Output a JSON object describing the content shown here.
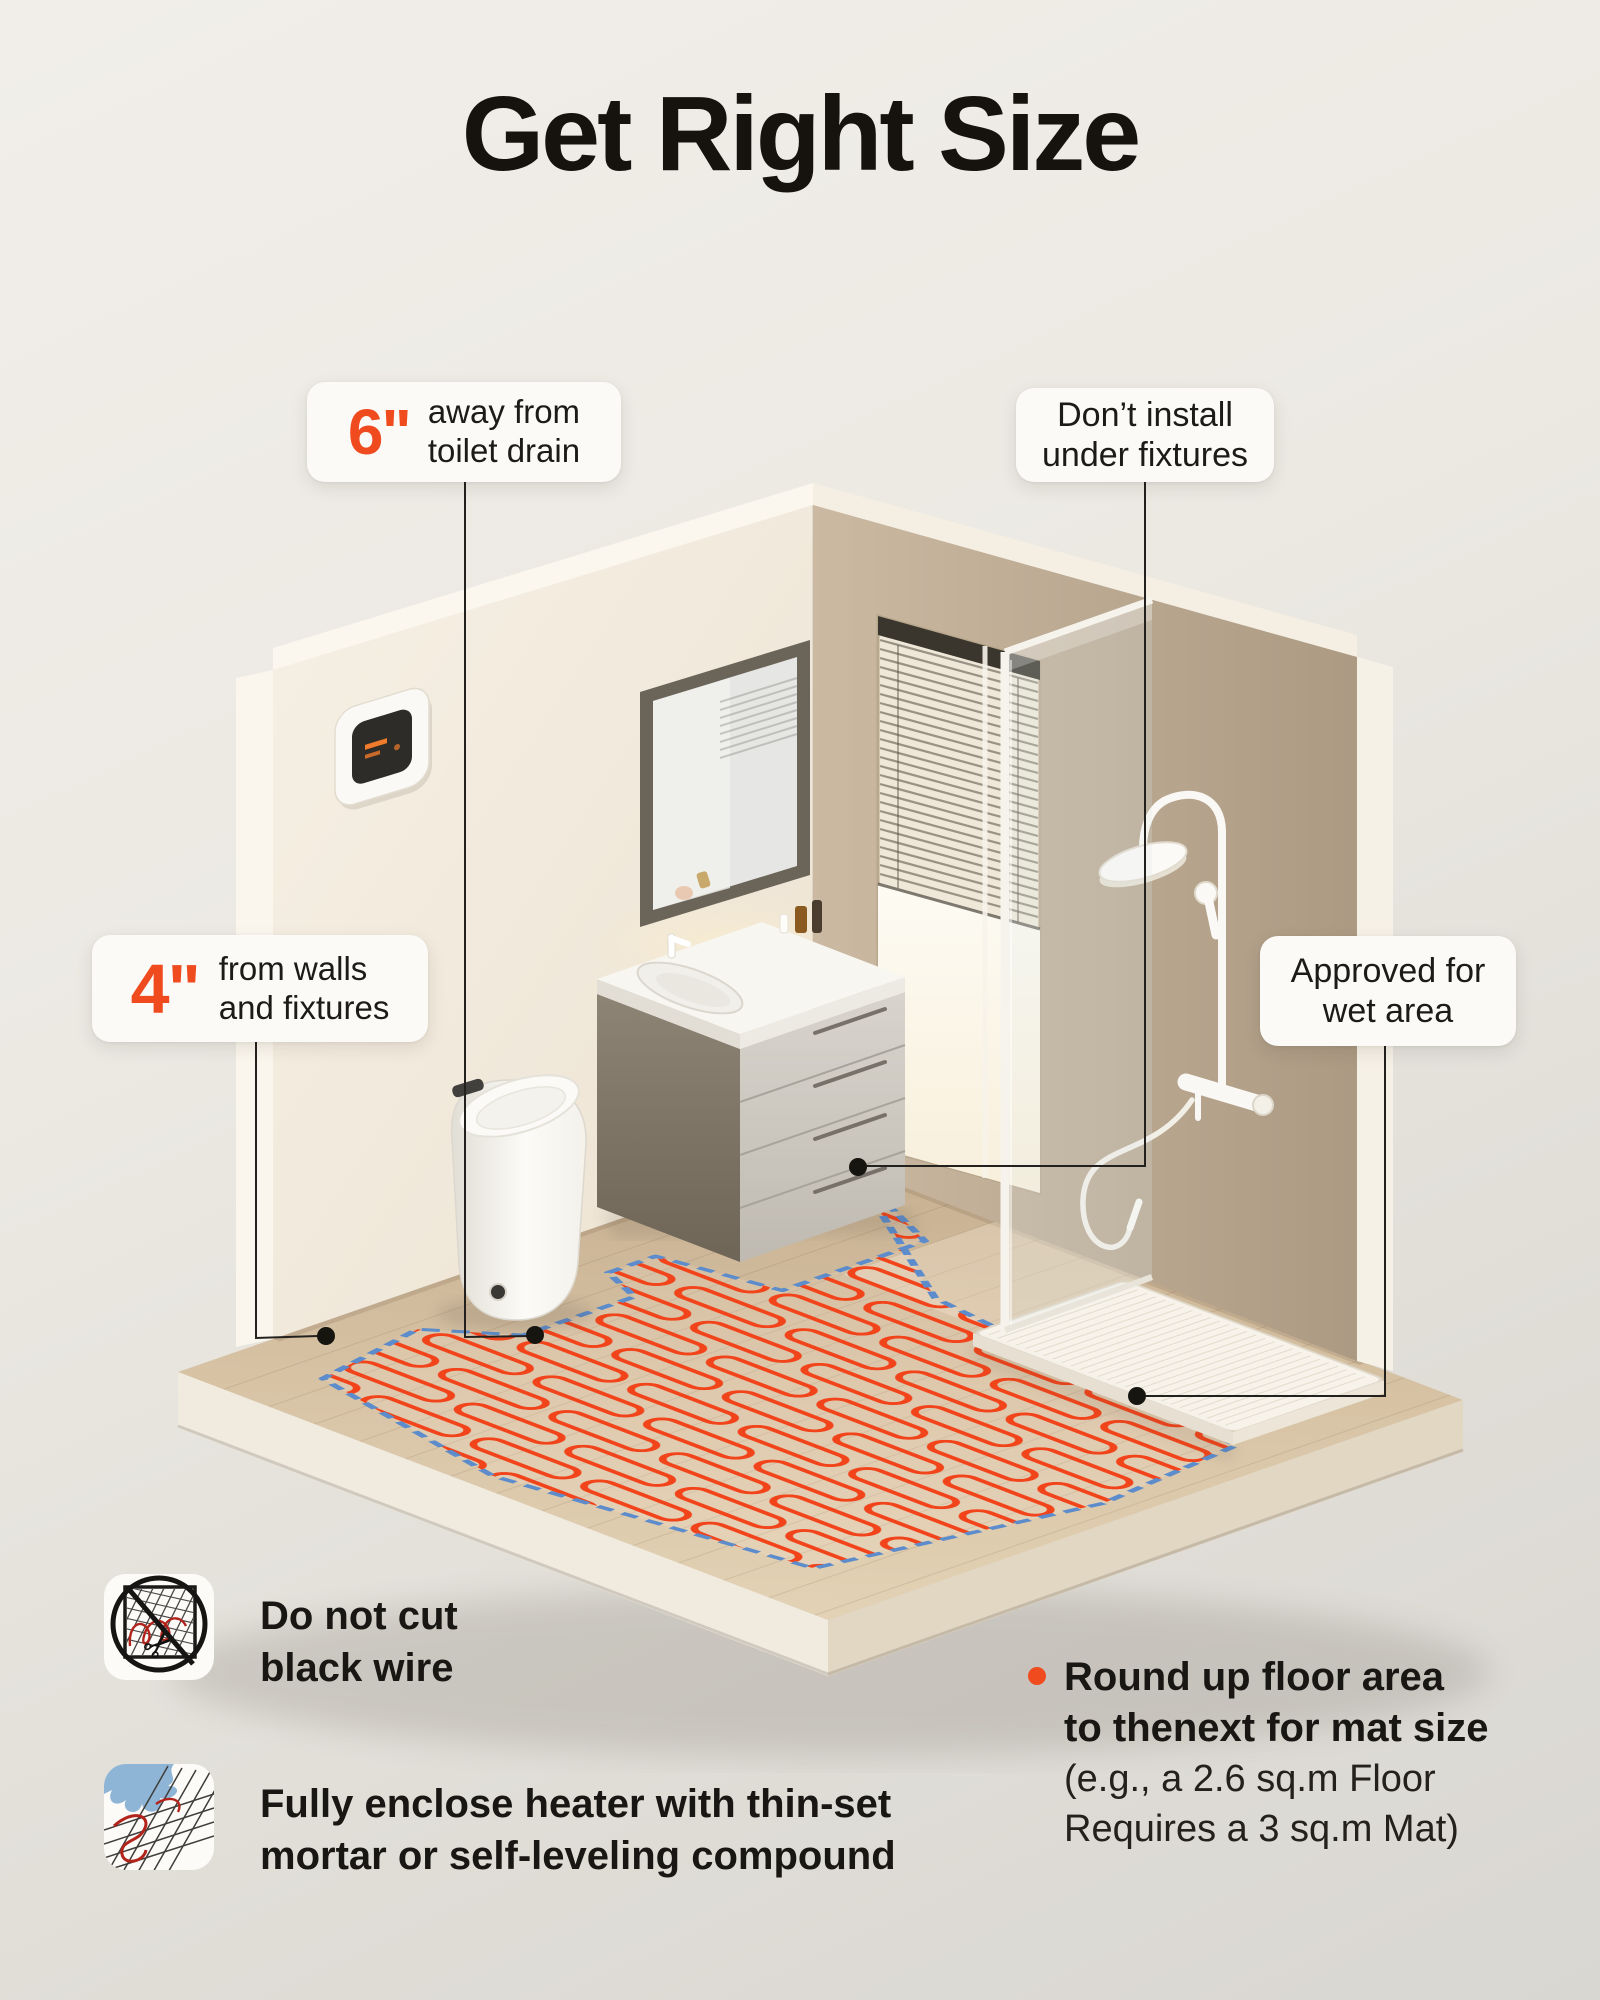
{
  "title": "Get Right Size",
  "colors": {
    "accent_orange": "#F04B1F",
    "heating_wire_red": "#F2441B",
    "mat_border_blue": "#5C8CCB",
    "callout_bg": "#FBFAF7",
    "text_dark": "#191713",
    "left_wall": "#F3EDE1",
    "right_wall": "#BFAD96",
    "floor_wood": "#D7C2A4"
  },
  "callouts": {
    "toilet_drain": {
      "value": "6\"",
      "line1": "away from",
      "line2": "toilet drain"
    },
    "no_fixtures": {
      "line1": "Don’t install",
      "line2": "under fixtures"
    },
    "walls_fixtures": {
      "value": "4\"",
      "line1": "from walls",
      "line2": "and fixtures"
    },
    "wet_area": {
      "line1": "Approved for",
      "line2": "wet area"
    }
  },
  "notes": {
    "do_not_cut": {
      "line1": "Do not cut",
      "line2": "black wire"
    },
    "enclose": {
      "line1": "Fully enclose heater with thin-set",
      "line2": "mortar or self-leveling compound"
    }
  },
  "tip": {
    "bold1": "Round up floor area",
    "bold2": "to thenext for mat size",
    "normal1": "(e.g., a 2.6 sq.m Floor",
    "normal2": "Requires a 3 sq.m Mat)"
  },
  "icons": {
    "no_cut": "no-cut-scissors-prohibition-icon",
    "mortar": "mortar-over-mesh-icon"
  }
}
